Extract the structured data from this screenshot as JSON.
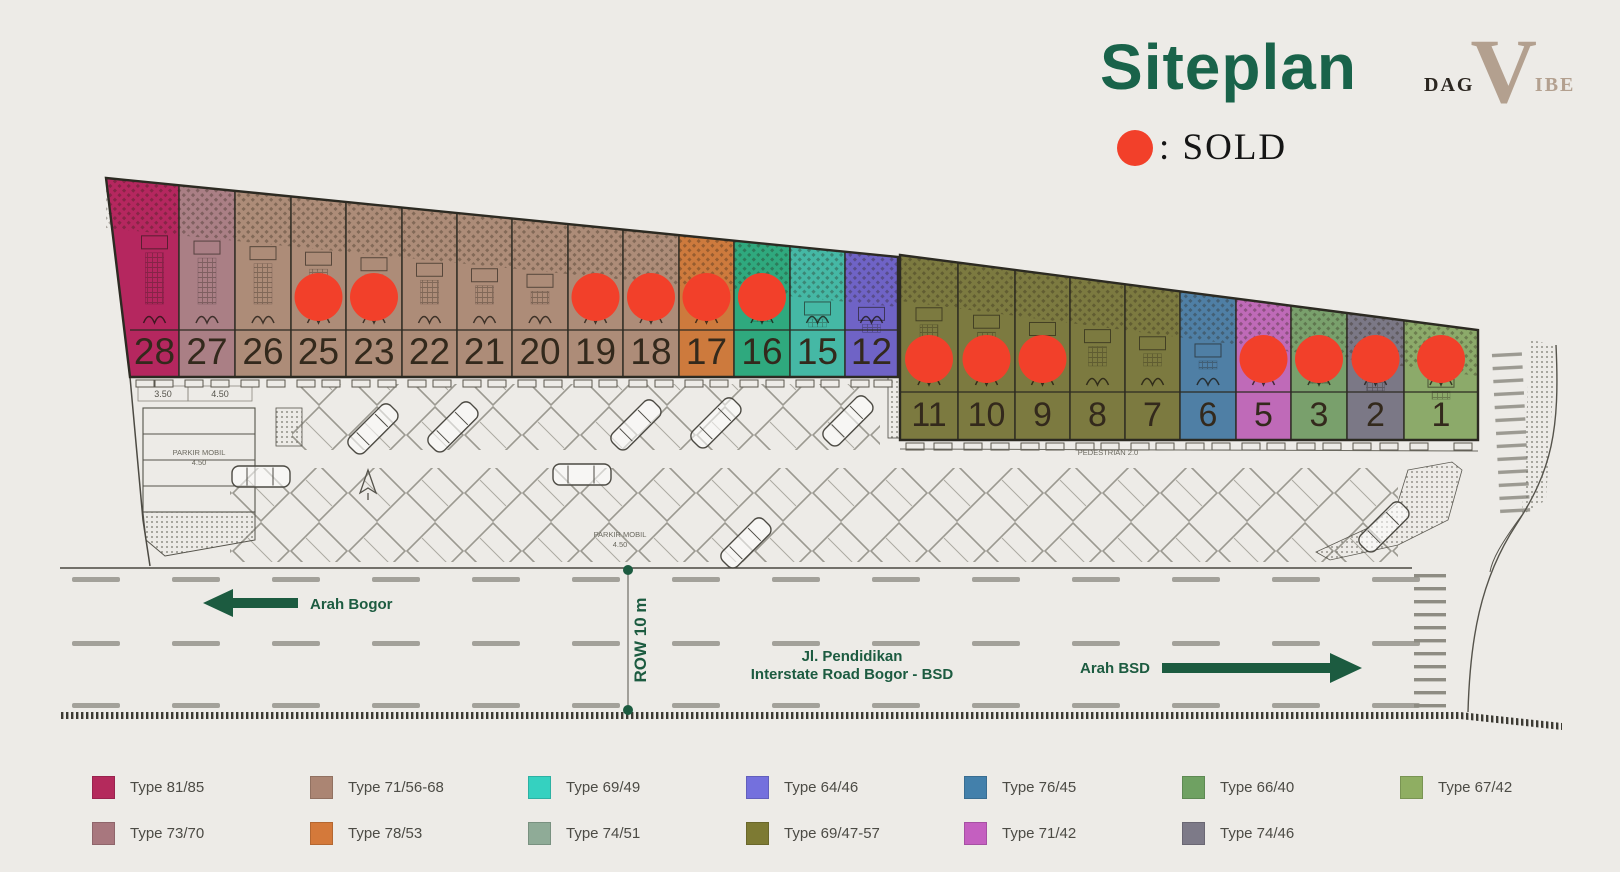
{
  "header": {
    "title": "Siteplan",
    "logo": {
      "dag": "DAG",
      "v": "V",
      "ibe": "IBE"
    },
    "sold": {
      "label": ": SOLD"
    }
  },
  "palette": {
    "paper": "#edebe7",
    "ink": "#2c2a22",
    "line": "#55534b",
    "green": "#1c5b40",
    "sold_red": "#f2402a",
    "number_color": "#33291c"
  },
  "siteplan": {
    "blocks": [
      {
        "id": "block-a",
        "bounds": [
          130,
          179,
          235,
          291,
          346,
          402,
          457,
          512,
          568,
          623,
          679,
          734,
          790,
          845,
          898
        ],
        "left_top_x": 106,
        "top_y_start": 178,
        "top_y_end": 257,
        "bottom_y": 377,
        "strip_y": 330,
        "roof_h": 50,
        "number_y": 364,
        "number_size": 37,
        "units": [
          {
            "no": "28",
            "color": "#b5275f",
            "sold": false
          },
          {
            "no": "27",
            "color": "#aa7f85",
            "sold": false
          },
          {
            "no": "26",
            "color": "#ad8c78",
            "sold": false
          },
          {
            "no": "25",
            "color": "#ad8c78",
            "sold": true
          },
          {
            "no": "23",
            "color": "#ad8c78",
            "sold": true
          },
          {
            "no": "22",
            "color": "#ad8c78",
            "sold": false
          },
          {
            "no": "21",
            "color": "#ad8c78",
            "sold": false
          },
          {
            "no": "20",
            "color": "#ad8c78",
            "sold": false
          },
          {
            "no": "19",
            "color": "#ad8c78",
            "sold": true
          },
          {
            "no": "18",
            "color": "#ad8c78",
            "sold": true
          },
          {
            "no": "17",
            "color": "#cd7a3d",
            "sold": true
          },
          {
            "no": "16",
            "color": "#2fa97e",
            "sold": true
          },
          {
            "no": "15",
            "color": "#45b8a5",
            "sold": false
          },
          {
            "no": "12",
            "color": "#6f63c6",
            "sold": false
          }
        ]
      },
      {
        "id": "block-b",
        "bounds": [
          900,
          958,
          1015,
          1070,
          1125,
          1180,
          1236,
          1291,
          1347,
          1404,
          1478
        ],
        "top_y_start": 255,
        "top_y_end": 330,
        "bottom_y": 440,
        "strip_y": 392,
        "roof_h": 46,
        "number_y": 426,
        "number_size": 34,
        "units": [
          {
            "no": "11",
            "color": "#7c7a40",
            "sold": true
          },
          {
            "no": "10",
            "color": "#7c7a40",
            "sold": true
          },
          {
            "no": "9",
            "color": "#7c7a40",
            "sold": true
          },
          {
            "no": "8",
            "color": "#7c7a40",
            "sold": false
          },
          {
            "no": "7",
            "color": "#7c7a40",
            "sold": false
          },
          {
            "no": "6",
            "color": "#4f7fa5",
            "sold": false
          },
          {
            "no": "5",
            "color": "#bf6ab8",
            "sold": true
          },
          {
            "no": "3",
            "color": "#79a06c",
            "sold": true
          },
          {
            "no": "2",
            "color": "#7b7886",
            "sold": true
          },
          {
            "no": "1",
            "color": "#8caa6a",
            "sold": true
          }
        ]
      }
    ],
    "road": {
      "dir_left": "Arah Bogor",
      "dir_right": "Arah BSD",
      "street_line1": "Jl. Pendidikan",
      "street_line2": "Interstate Road Bogor - BSD",
      "row_label": "ROW 10 m"
    },
    "annotations": {
      "parkir_line1": "PARKIR MOBIL",
      "parkir_line2": "4.50",
      "pedestrian": "PEDESTRIAN 2.0",
      "dim_a": "3.50",
      "dim_b": "4.50"
    }
  },
  "legend": {
    "items": [
      {
        "label": "Type 81/85",
        "color": "#b42a5c"
      },
      {
        "label": "Type 71/56-68",
        "color": "#ab8573"
      },
      {
        "label": "Type 69/49",
        "color": "#35d1c0"
      },
      {
        "label": "Type 64/46",
        "color": "#7470dd"
      },
      {
        "label": "Type 76/45",
        "color": "#4380ab"
      },
      {
        "label": "Type 66/40",
        "color": "#6fa162"
      },
      {
        "label": "Type 67/42",
        "color": "#8fae62"
      },
      {
        "label": "Type 73/70",
        "color": "#a8777e"
      },
      {
        "label": "Type 78/53",
        "color": "#d4793a"
      },
      {
        "label": "Type 74/51",
        "color": "#8fab97"
      },
      {
        "label": "Type 69/47-57",
        "color": "#7d7a33"
      },
      {
        "label": "Type 71/42",
        "color": "#c45fc0"
      },
      {
        "label": "Type 74/46",
        "color": "#7d7a88"
      }
    ]
  }
}
